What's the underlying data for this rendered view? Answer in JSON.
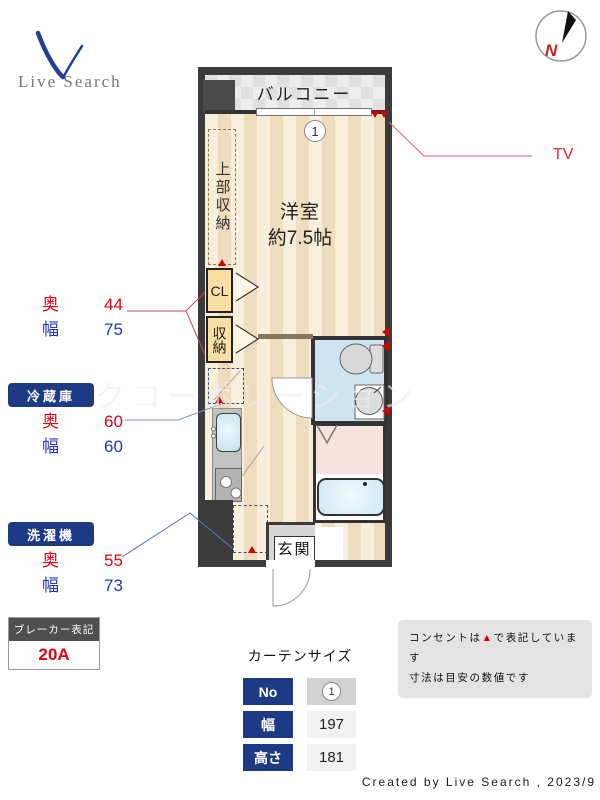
{
  "colors": {
    "accent_red": "#e60012",
    "accent_blue": "#2333c4",
    "navy": "#1d3a85",
    "outlet_red": "#d60000",
    "wall": "#3b3b3b",
    "tv_red": "#e8232a"
  },
  "logo": {
    "brand": "Live Search"
  },
  "compass": {
    "letter": "N"
  },
  "plan": {
    "balcony_label": "バルコニー",
    "window_no": "1",
    "room_name": "洋室",
    "room_size": "約7.5帖",
    "upper_storage_label": "上部収納",
    "cl_label": "CL",
    "storage_label": "収納",
    "entrance_label": "玄関",
    "watermark": "クコーポレーション"
  },
  "annotations": {
    "tv_label": "TV",
    "closet": {
      "depth_label": "奥",
      "depth_value": "44",
      "width_label": "幅",
      "width_value": "75"
    },
    "fridge": {
      "title": "冷蔵庫",
      "depth_label": "奥",
      "depth_value": "60",
      "width_label": "幅",
      "width_value": "60"
    },
    "washer": {
      "title": "洗濯機",
      "depth_label": "奥",
      "depth_value": "55",
      "width_label": "幅",
      "width_value": "73"
    }
  },
  "breaker": {
    "title": "ブレーカー表記",
    "value": "20A"
  },
  "curtain": {
    "title": "カーテンサイズ",
    "rows": [
      {
        "label": "No",
        "value": "1"
      },
      {
        "label": "幅",
        "value": "197"
      },
      {
        "label": "高さ",
        "value": "181"
      }
    ]
  },
  "note": {
    "line1_pre": "コンセントは",
    "line1_marker": "▲",
    "line1_post": "で表記しています",
    "line2": "寸法は目安の数値です"
  },
  "credit": "Created by Live Search , 2023/9"
}
